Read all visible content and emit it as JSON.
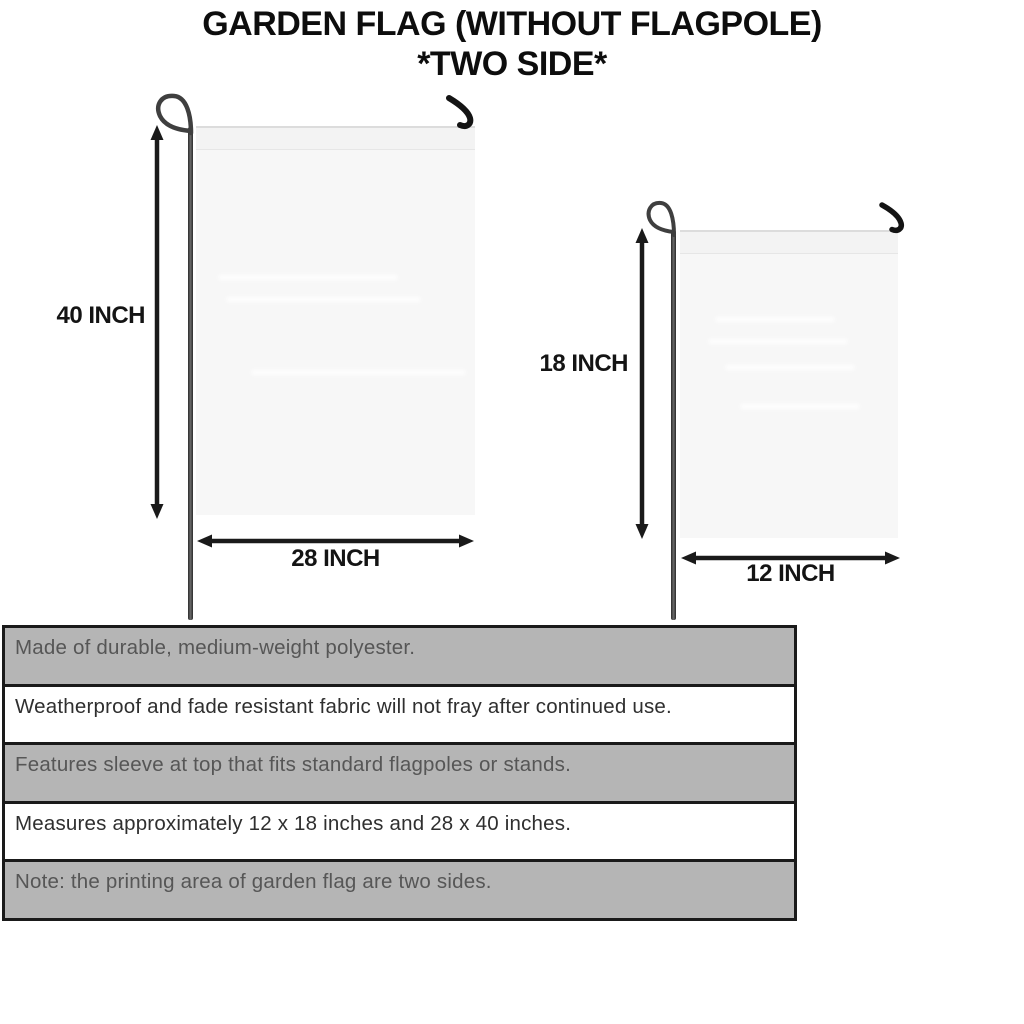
{
  "title": {
    "line1": "GARDEN FLAG (WITHOUT FLAGPOLE)",
    "line2": "*TWO SIDE*"
  },
  "flags": {
    "large": {
      "height_label": "40 INCH",
      "width_label": "28 INCH"
    },
    "small": {
      "height_label": "18 INCH",
      "width_label": "12 INCH"
    }
  },
  "features": {
    "rows": [
      {
        "text": "Made of durable, medium-weight polyester."
      },
      {
        "text": "Weatherproof and fade resistant fabric will not fray after continued use."
      },
      {
        "text": "Features sleeve at top that fits standard flagpoles or stands."
      },
      {
        "text": "Measures approximately 12 x 18 inches and 28 x 40 inches."
      },
      {
        "text": "Note: the printing area of garden flag are two sides."
      }
    ]
  },
  "colors": {
    "row_gray": "#b5b5b5",
    "row_white": "#ffffff",
    "border": "#1a1a1a",
    "flag_fill": "#f7f7f7",
    "title_text": "#0d0d0d",
    "table_gray_text": "#565656",
    "table_white_text": "#2f2f2f"
  }
}
